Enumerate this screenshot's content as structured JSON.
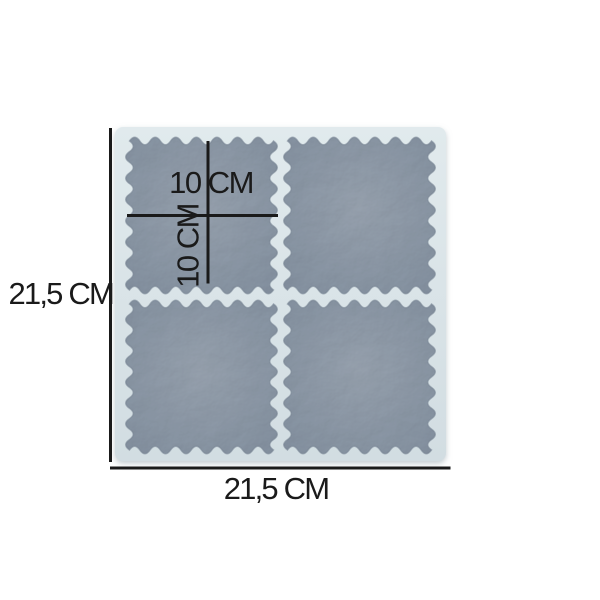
{
  "image": {
    "description": "White silicone mold with four square wavy-edge coaster cavities, annotated with measurement lines",
    "background": "#ffffff"
  },
  "labels": {
    "overall_height": "21,5 CM",
    "overall_width": "21,5 CM",
    "cavity_width": "10 CM",
    "cavity_height": "10 CM"
  },
  "colors": {
    "mold_light": "#e1eaed",
    "mold_dark": "#d2dde2",
    "cavity_light": "#98a3b0",
    "cavity_dark": "#8390a0",
    "cavity_rim": "#7e8c9b",
    "mold_shadow": "#aab6bd",
    "dimension_ink": "#1a1a1a"
  }
}
